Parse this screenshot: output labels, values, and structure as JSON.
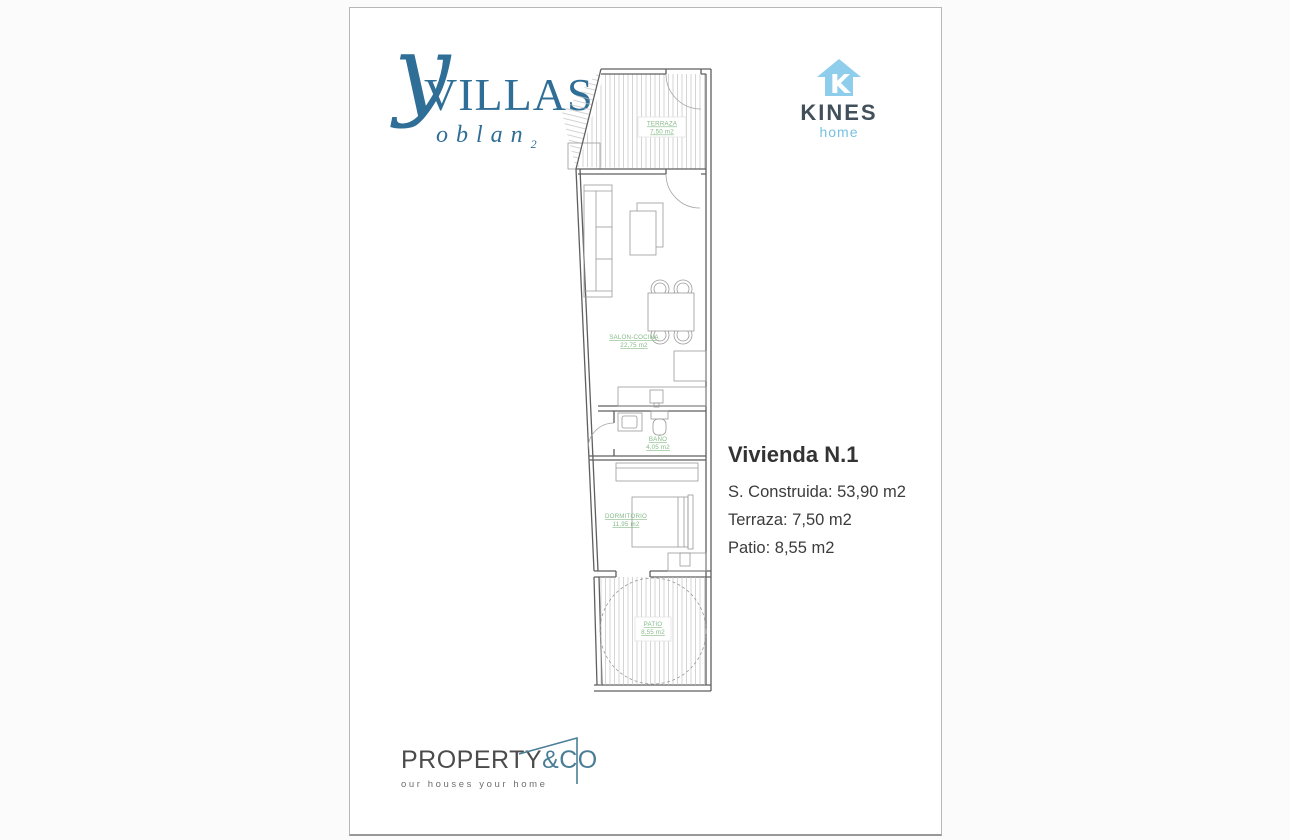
{
  "page": {
    "background": "#fbfbfb",
    "paper": "#ffffff"
  },
  "brand_villas": {
    "glyph": "y",
    "word": "VILLAS",
    "sub_word": "oblan",
    "sub_index": "2",
    "color": "#2f6e96"
  },
  "brand_kines": {
    "word": "KINES",
    "sub_word": "home",
    "icon": "house-k-icon",
    "icon_color": "#8ecdec",
    "text_color": "#41505a"
  },
  "brand_property": {
    "word": "PROPERTY",
    "accent": "&CO",
    "tagline": "our houses your home",
    "accent_color": "#4a7e97"
  },
  "info": {
    "title": "Vivienda N.1",
    "line1": "S. Construida: 53,90 m2",
    "line2": "Terraza: 7,50 m2",
    "line3": "Patio: 8,55 m2"
  },
  "plan": {
    "label_color": "#85ba87",
    "wall_color": "#5f5f5f",
    "terraza_name": "TERRAZA",
    "terraza_area": "7,50 m2",
    "salon_name": "SALON-COCINA",
    "salon_area": "22,75 m2",
    "bano_name": "BAÑO",
    "bano_area": "4,05 m2",
    "dorm_name": "DORMITORIO",
    "dorm_area": "11,95 m2",
    "patio_name": "PATIO",
    "patio_area": "8,55 m2"
  }
}
